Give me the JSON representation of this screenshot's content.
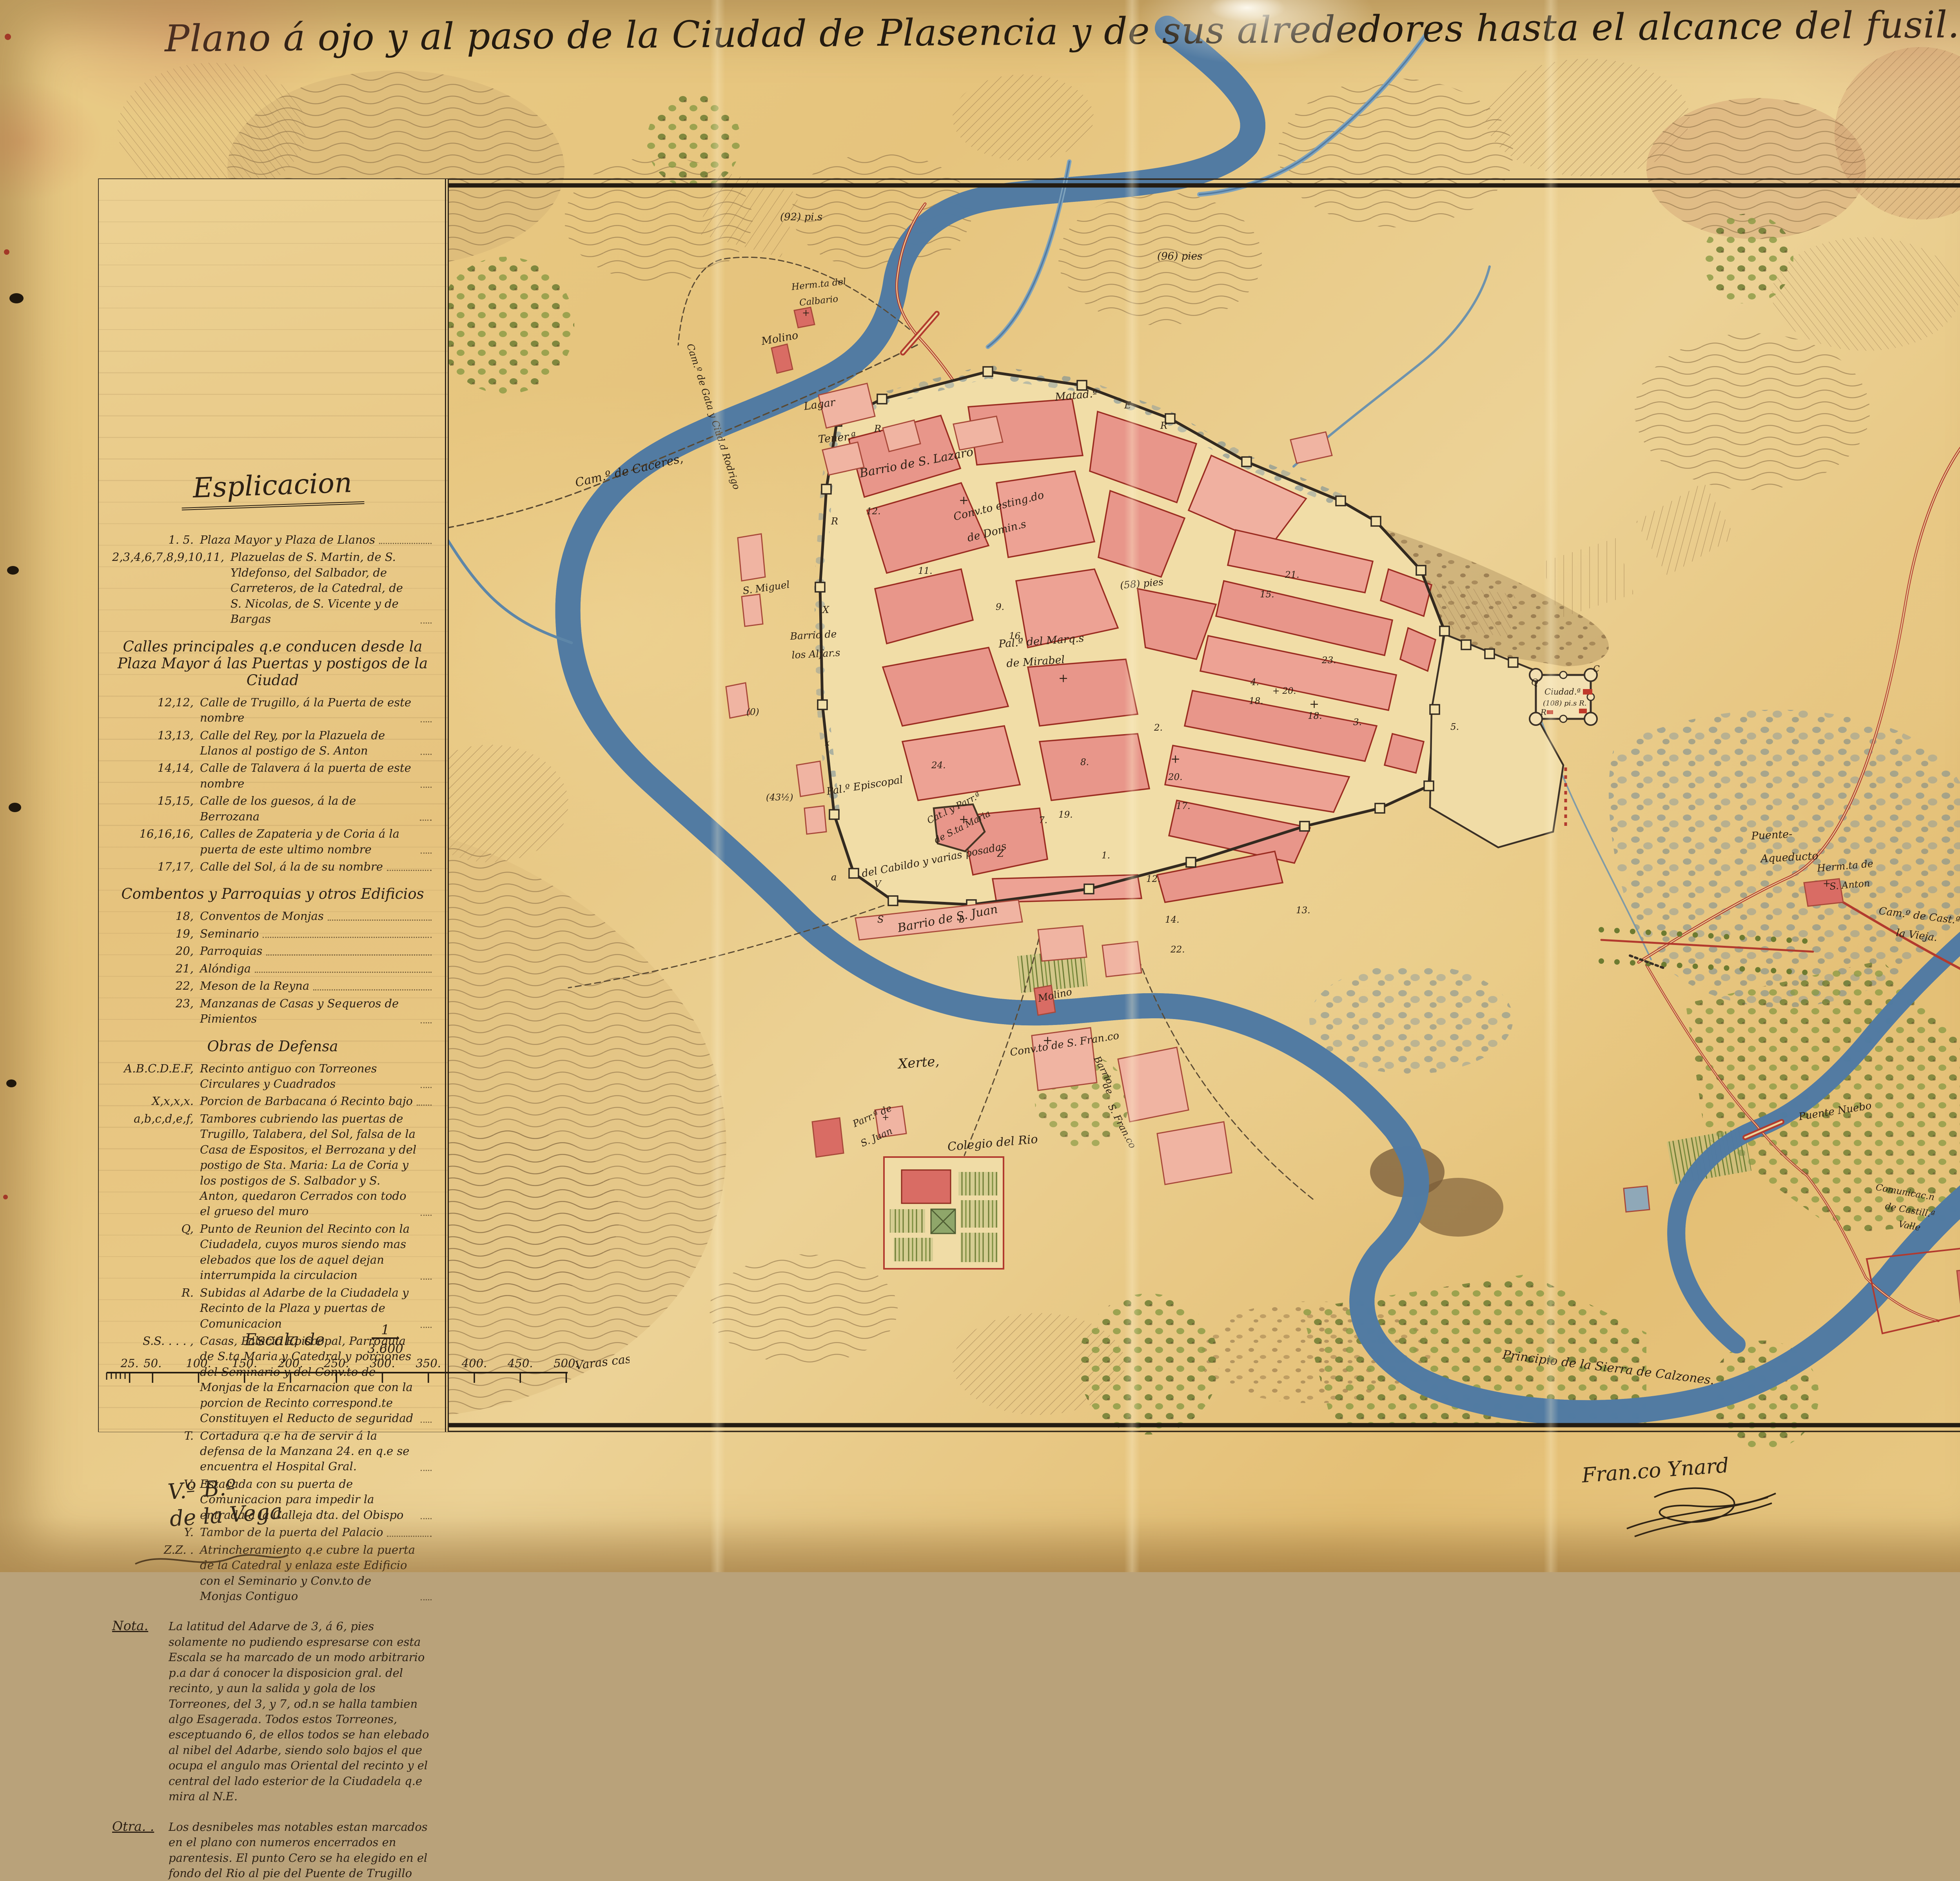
{
  "title": "Plano á ojo y al paso de la Ciudad de Plasencia y de sus alrededores hasta el alcance del fusil. Año de 1839.",
  "colors": {
    "paper": "#e8c983",
    "ink": "#2c2014",
    "city_pink": "#e8968a",
    "river_blue": "#517ba2",
    "olive_green": "#6f7d33",
    "road_red": "#b23a2e"
  },
  "legend": {
    "title": "Esplicacion",
    "entries": [
      {
        "key": "1. 5.",
        "text": "Plaza Mayor y Plaza de Llanos"
      },
      {
        "key": "2,3,4,6,7,8,9,10,11,",
        "text": "Plazuelas de S. Martin, de S. Yldefonso, del Salbador, de Carreteros, de la Catedral, de S. Nicolas, de S. Vicente y de Bargas"
      },
      {
        "type": "header",
        "text": "Calles principales q.e conducen desde la Plaza Mayor á las Puertas y postigos de la Ciudad"
      },
      {
        "key": "12,12,",
        "text": "Calle de Trugillo, á la Puerta de este nombre"
      },
      {
        "key": "13,13,",
        "text": "Calle del Rey, por la Plazuela de Llanos al postigo de S. Anton"
      },
      {
        "key": "14,14,",
        "text": "Calle de Talavera á la puerta de este nombre"
      },
      {
        "key": "15,15,",
        "text": "Calle de los guesos, á la de Berrozana"
      },
      {
        "key": "16,16,16,",
        "text": "Calles de Zapateria y de Coria á la puerta de este ultimo nombre"
      },
      {
        "key": "17,17,",
        "text": "Calle del Sol, á la de su nombre"
      },
      {
        "type": "header",
        "text": "Combentos y Parroquias y otros Edificios"
      },
      {
        "key": "18,",
        "text": "Conventos de Monjas"
      },
      {
        "key": "19,",
        "text": "Seminario"
      },
      {
        "key": "20,",
        "text": "Parroquias"
      },
      {
        "key": "21,",
        "text": "Alóndiga"
      },
      {
        "key": "22,",
        "text": "Meson de la Reyna"
      },
      {
        "key": "23,",
        "text": "Manzanas de Casas y Sequeros de Pimientos"
      },
      {
        "type": "header",
        "text": "Obras de Defensa"
      },
      {
        "key": "A.B.C.D.E.F,",
        "text": "Recinto antiguo con Torreones Circulares y Cuadrados"
      },
      {
        "key": "X,x,x,x.",
        "text": "Porcion de Barbacana ó Recinto bajo"
      },
      {
        "key": "a,b,c,d,e,f,",
        "text": "Tambores cubriendo las puertas de Trugillo, Talabera, del Sol, falsa de la Casa de Espositos, el Berrozana y del postigo de Sta. Maria: La de Coria y los postigos de S. Salbador y S. Anton, quedaron Cerrados con todo el grueso del muro"
      },
      {
        "key": "Q,",
        "text": "Punto de Reunion del Recinto con la Ciudadela, cuyos muros siendo mas elebados que los de aquel dejan interrumpida la circulacion"
      },
      {
        "key": "R.",
        "text": "Subidas al Adarbe de la Ciudadela y Recinto de la Plaza y puertas de Comunicacion"
      },
      {
        "key": "S.S. . . . ,",
        "text": "Casas, Palacio Episcopal, Parroquia de S.ta Maria y Catedral y porciones del Seminario y del Conv.to de Monjas de la Encarnacion que con la porcion de Recinto correspond.te Constituyen el Reducto de seguridad"
      },
      {
        "key": "T.",
        "text": "Cortadura q.e ha de servir á la defensa de la Manzana 24. en q.e se encuentra el Hospital Gral."
      },
      {
        "key": "V.",
        "text": "Estacada con su puerta de Comunicacion para impedir la entrada á la Calleja dta. del Obispo"
      },
      {
        "key": "Y.",
        "text": "Tambor de la puerta del Palacio"
      },
      {
        "key": "Z.Z. .",
        "text": "Atrincheramiento q.e cubre la puerta de la Catedral y enlaza este Edificio con el Seminario y Conv.to de Monjas Contiguo"
      },
      {
        "type": "note",
        "key": "Nota.",
        "text": "La latitud del Adarve de 3, á 6, pies solamente no pudiendo espresarse con esta Escala se ha marcado de un modo arbitrario p.a dar á conocer la disposicion gral. del recinto, y aun la salida y gola de los Torreones, del 3, y 7, od.n se halla tambien algo Esagerada. Todos estos Torreones, esceptuando 6, de ellos todos se han elebado al nibel del Adarbe, siendo solo bajos el que ocupa el angulo mas Oriental del recinto y el central del lado esterior de la Ciudadela q.e mira al N.E."
      },
      {
        "type": "note",
        "key": "Otra. .",
        "text": "Los desnibeles mas notables estan marcados en el plano con numeros encerrados en parentesis. El punto Cero se ha elegido en el fondo del Rio al pie del Puente de Trugillo"
      }
    ]
  },
  "scale": {
    "caption": "Escala de",
    "fraction_numerator": "1",
    "fraction_denominator": "3.600",
    "ticks": [
      "25",
      "50",
      "100",
      "150",
      "200",
      "250",
      "300",
      "350",
      "400",
      "450",
      "500"
    ],
    "unit": "Varas castell.s"
  },
  "signatures": {
    "left_line1": "V.º B.º",
    "left_line2": "de la Vega",
    "right": "Fran.co Ynard"
  },
  "map": {
    "labels": [
      [
        "Arroyo de niebla",
        618,
        692,
        -8,
        30
      ],
      [
        "Cam.º de Gata y Ciud.d Rodrigo",
        1752,
        880,
        72,
        24
      ],
      [
        "Cam.º de Caceres,",
        1470,
        1242,
        -13,
        30
      ],
      [
        "Herm.ta del",
        2020,
        740,
        -6,
        23
      ],
      [
        "Calbario",
        2040,
        780,
        -6,
        23
      ],
      [
        "(92) pi.s",
        1990,
        562,
        0,
        26
      ],
      [
        "(96) pies",
        2952,
        662,
        0,
        26
      ],
      [
        "Molino",
        1944,
        880,
        -10,
        27
      ],
      [
        "Lagar",
        2052,
        1046,
        -8,
        27
      ],
      [
        "Tener.ª",
        2088,
        1130,
        -5,
        27
      ],
      [
        "Barrio de S. Lazaro",
        2195,
        1218,
        -11,
        30
      ],
      [
        "Matad.º",
        2692,
        1022,
        -5,
        27
      ],
      [
        "Conv.to esting.do",
        2435,
        1328,
        -14,
        27
      ],
      [
        "de Domin.s",
        2470,
        1382,
        -14,
        27
      ],
      [
        "Pal.º del Marq.s",
        2548,
        1652,
        -4,
        27
      ],
      [
        "de Mirabel",
        2568,
        1702,
        -4,
        27
      ],
      [
        "S. Miguel",
        1896,
        1516,
        -8,
        25
      ],
      [
        "Barrio de",
        2016,
        1632,
        -3,
        25
      ],
      [
        "los Alfar.s",
        2020,
        1680,
        -3,
        25
      ],
      [
        "(58) pies",
        2858,
        1502,
        -5,
        25
      ],
      [
        "(43½)",
        1954,
        2042,
        0,
        23
      ],
      [
        "(0)",
        1904,
        1824,
        0,
        23
      ],
      [
        "Ciudad.ª",
        3940,
        1772,
        0,
        21
      ],
      [
        "(108) pi.s R.",
        3936,
        1800,
        0,
        18
      ],
      [
        "Puente-",
        4468,
        2142,
        -3,
        27
      ],
      [
        "Aqueducto",
        4492,
        2200,
        -3,
        27
      ],
      [
        "Herm.ta de",
        4636,
        2224,
        -5,
        25
      ],
      [
        "S. Anton",
        4668,
        2270,
        -5,
        24
      ],
      [
        "Cam.º de Cast.ª",
        4792,
        2332,
        7,
        26
      ],
      [
        "la Vieja.",
        4836,
        2388,
        7,
        26
      ],
      [
        "Xerte,",
        2292,
        2726,
        -4,
        34
      ],
      [
        "Molino",
        2650,
        2556,
        -12,
        25
      ],
      [
        "Colegio del Rio",
        2418,
        2936,
        -5,
        30
      ],
      [
        "Barrio de S. Juan",
        2292,
        2378,
        -11,
        30
      ],
      [
        "del Cabildo y varias posadas",
        2200,
        2238,
        -11,
        26
      ],
      [
        "Pal.º Episcopal",
        2110,
        2028,
        -9,
        26
      ],
      [
        "Cat.l y Parr.ª",
        2370,
        2102,
        -27,
        23
      ],
      [
        "de S.ta Maria",
        2388,
        2152,
        -27,
        23
      ],
      [
        "Conv.to de S. Fran.co",
        2578,
        2694,
        -9,
        26
      ],
      [
        "Barrio",
        2790,
        2700,
        62,
        24
      ],
      [
        "de",
        2812,
        2768,
        62,
        24
      ],
      [
        "S. Fran.co",
        2826,
        2822,
        62,
        24
      ],
      [
        "Parr.ª de",
        2180,
        2876,
        -24,
        24
      ],
      [
        "S. Juan",
        2200,
        2926,
        -24,
        24
      ],
      [
        "Principio de la Sierra de Calzones.",
        3832,
        3466,
        7,
        31
      ],
      [
        "Puente Nuebo",
        4590,
        2858,
        -9,
        26
      ],
      [
        "Comunicac.n",
        4784,
        3036,
        10,
        23
      ],
      [
        "de Castill.ª",
        4808,
        3084,
        10,
        23
      ],
      [
        "Valle",
        4842,
        3130,
        10,
        23
      ],
      [
        "11.",
        2342,
        1464,
        0,
        23
      ],
      [
        "9.",
        2540,
        1556,
        0,
        23
      ],
      [
        "16.",
        2574,
        1630,
        0,
        23
      ],
      [
        "8.",
        2756,
        1952,
        0,
        23
      ],
      [
        "24.",
        2376,
        1960,
        0,
        23
      ],
      [
        "2.",
        2944,
        1864,
        0,
        23
      ],
      [
        "18.",
        3186,
        1796,
        0,
        23
      ],
      [
        "18.",
        3336,
        1834,
        0,
        23
      ],
      [
        "3.",
        3452,
        1850,
        0,
        23
      ],
      [
        "20.",
        2980,
        1990,
        0,
        23
      ],
      [
        "1.",
        2810,
        2190,
        0,
        23
      ],
      [
        "12.",
        2924,
        2250,
        0,
        23
      ],
      [
        "13.",
        3306,
        2330,
        0,
        23
      ],
      [
        "14.",
        2972,
        2354,
        0,
        23
      ],
      [
        "22.",
        2986,
        2430,
        0,
        23
      ],
      [
        "23.",
        3372,
        1692,
        0,
        23
      ],
      [
        "21.",
        3278,
        1474,
        0,
        23
      ],
      [
        "15.",
        3214,
        1524,
        0,
        23
      ],
      [
        "19.",
        2700,
        2086,
        0,
        23
      ],
      [
        "17.",
        3000,
        2064,
        0,
        23
      ],
      [
        "12.",
        2210,
        1312,
        0,
        23
      ],
      [
        "5.",
        3700,
        1862,
        0,
        23
      ],
      [
        "4.",
        3190,
        1748,
        0,
        23
      ],
      [
        "+ 20.",
        3246,
        1770,
        0,
        22
      ],
      [
        "7.",
        2650,
        2100,
        0,
        23
      ],
      [
        "R",
        2230,
        1102,
        0,
        24
      ],
      [
        "R",
        2960,
        1094,
        0,
        24
      ],
      [
        "E",
        2868,
        1042,
        0,
        24
      ],
      [
        "R",
        2120,
        1338,
        0,
        24
      ],
      [
        "X",
        2098,
        1564,
        0,
        24
      ],
      [
        "Q",
        3906,
        1748,
        0,
        22
      ],
      [
        "C",
        4064,
        1714,
        0,
        22
      ],
      [
        "R",
        3930,
        1824,
        0,
        20
      ],
      [
        "a",
        2120,
        2246,
        0,
        24
      ],
      [
        "V",
        2230,
        2264,
        0,
        24
      ],
      [
        "S",
        2238,
        2354,
        0,
        24
      ],
      [
        "Z",
        2544,
        2186,
        0,
        24
      ],
      [
        "b",
        2446,
        2354,
        0,
        24
      ],
      [
        "x",
        2104,
        1902,
        0,
        22
      ],
      [
        "+",
        2446,
        1286,
        0,
        30
      ],
      [
        "+",
        2700,
        1740,
        0,
        30
      ],
      [
        "+",
        2986,
        1946,
        0,
        30
      ],
      [
        "+",
        3340,
        1806,
        0,
        30
      ],
      [
        "+",
        2660,
        2664,
        0,
        30
      ],
      [
        "+",
        2446,
        2100,
        0,
        30
      ],
      [
        "+",
        4650,
        2262,
        0,
        24
      ],
      [
        "+",
        2250,
        2858,
        0,
        22
      ],
      [
        "+",
        2046,
        806,
        0,
        24
      ]
    ]
  }
}
